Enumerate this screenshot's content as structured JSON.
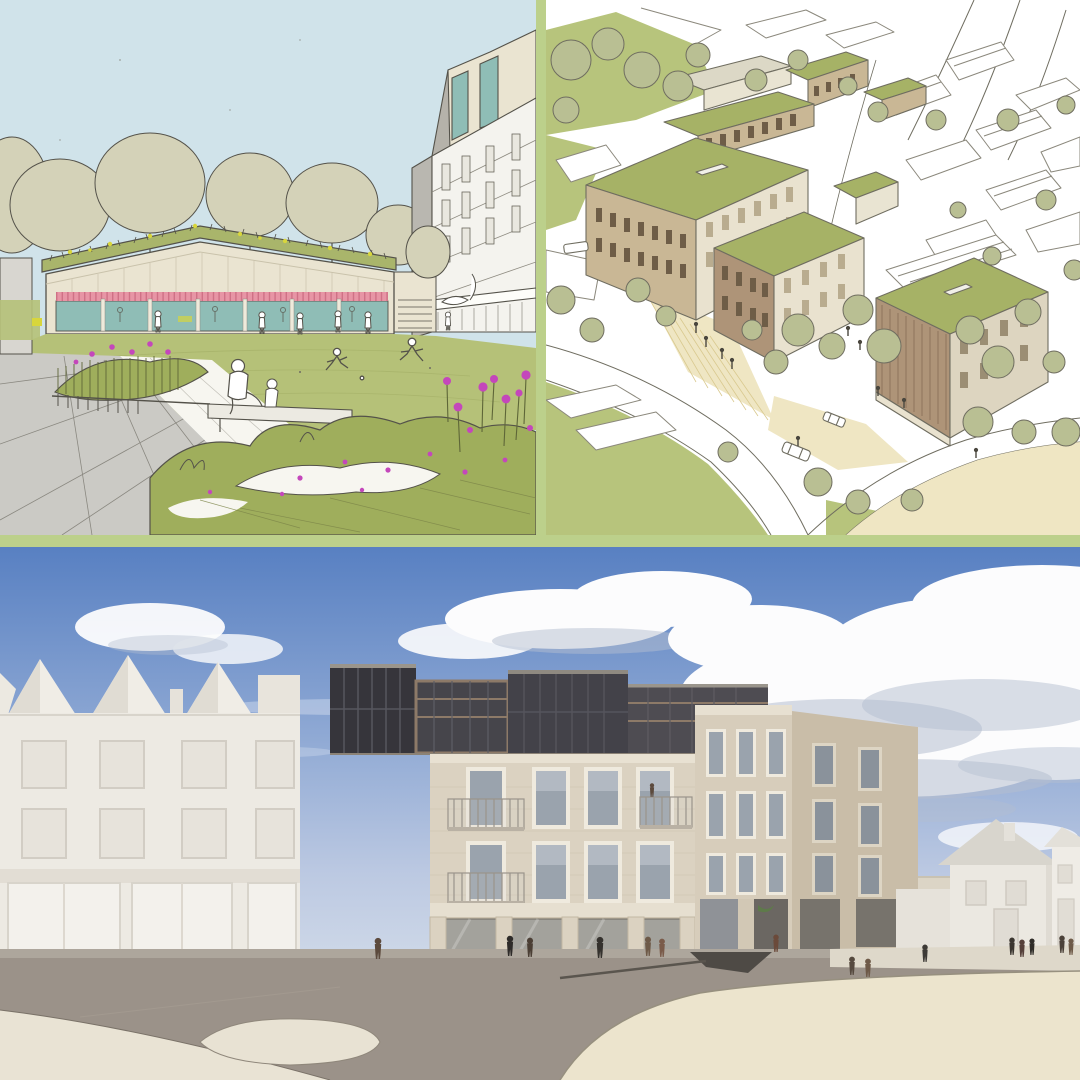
{
  "meta": {
    "title": "Architectural visualisation collage",
    "panel_count": 3
  },
  "panels": [
    {
      "id": "park-pavilion-sketch",
      "style": "hand-drawn concept sketch",
      "subject": "single-storey pavilion with wildflower green roof on a park lawn, six-storey apartment block behind"
    },
    {
      "id": "aerial-masterplan-sketch",
      "style": "hand-drawn aerial concept sketch",
      "subject": "courtyard housing blocks with green roofs, street trees and surrounding streets"
    },
    {
      "id": "street-view-render",
      "style": "photorealistic 3D render",
      "subject": "four-storey brick apartment building with dark set-back top floor and ground-floor colonnade beside white buildings on a pedestrian plaza"
    }
  ],
  "palette": {
    "divider_green": "#bcd08b",
    "p1_sky": "#d0e3ea",
    "p1_paper": "#f7f6f0",
    "p1_line": "#54524a",
    "p1_cream": "#eae4d1",
    "p1_gray": "#b9b7b0",
    "p1_white": "#f4f3ee",
    "p1_roof_green": "#a9b56b",
    "p1_grass": "#b5c178",
    "p1_shrub": "#9fae5c",
    "p1_teal": "#8fbdb6",
    "p1_pink": "#e795a5",
    "p1_pink_dark": "#cf7186",
    "p1_yellow": "#d8d63c",
    "p1_magenta": "#c447bb",
    "p1_pave": "#cbcac5",
    "p1_pave_line": "#8a8880",
    "p1_tree": "#d4d2b8",
    "p2_line": "#6f6d60",
    "p2_sketch": "#8b887c",
    "p2_green": "#b7c47c",
    "p2_roof": "#a6b266",
    "p2_wood": "#c9b795",
    "p2_wood_dark": "#ae9478",
    "p2_slat": "#6e5d47",
    "p2_cream": "#e9e2cf",
    "p2_path": "#efe6c3",
    "p2_tree": "#b9bf93",
    "p3_sky_top": "#5880c2",
    "p3_sky_mid": "#8fa9d4",
    "p3_sky_low": "#cfd9e8",
    "p3_cloud": "#fcfcfd",
    "p3_cloud_shadow": "#b4bed0",
    "p3_white": "#edeae3",
    "p3_white_shade": "#e0dcd3",
    "p3_roof_gray": "#d8d5cd",
    "p3_brick": "#dbd2c1",
    "p3_brick_dark": "#c9bda8",
    "p3_frame": "#efeade",
    "p3_glass": "#9aa3ad",
    "p3_dark": "#46454b",
    "p3_darker": "#36353b",
    "p3_bronze": "#8d7a68",
    "p3_road": "#9b9289",
    "p3_cream": "#ece4cd",
    "p3_kerb": "#7a7268",
    "p3_person": "#3d3a36"
  }
}
